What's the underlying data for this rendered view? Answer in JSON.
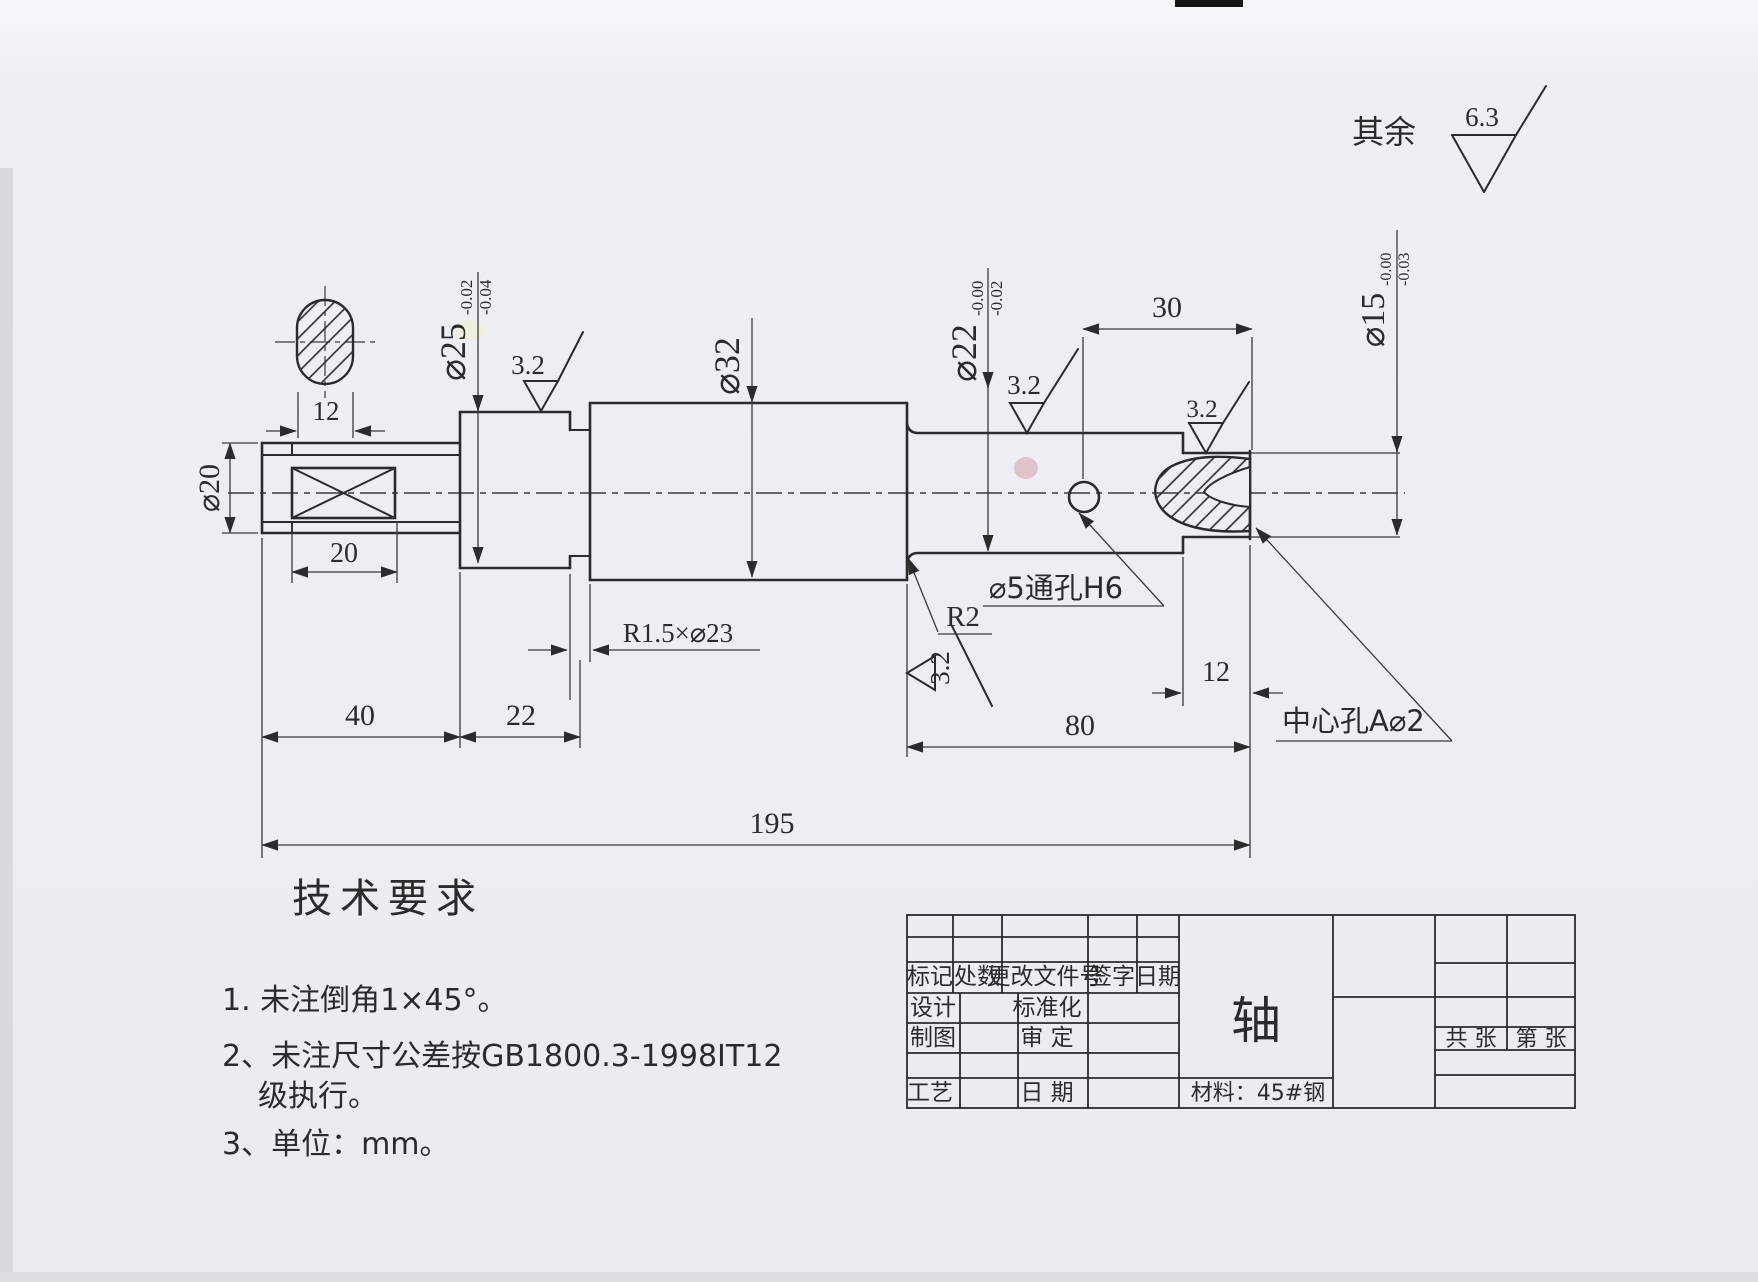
{
  "general": {
    "rest_label": "其余",
    "rest_roughness": "6.3"
  },
  "dims": {
    "key_width": "12",
    "d20": "⌀20",
    "len20": "20",
    "len40": "40",
    "len22": "22",
    "d25": "⌀25",
    "d25_up": "-0.02",
    "d25_lo": "-0.04",
    "ra1": "3.2",
    "ra2": "3.2",
    "ra3": "3.2",
    "ra4": "3.2",
    "groove": "R1.5×⌀23",
    "d32": "⌀32",
    "r2": "R2",
    "d22": "⌀22",
    "d22_up": "-0.00",
    "d22_lo": "-0.02",
    "hole": "⌀5通孔H6",
    "len30": "30",
    "d15": "⌀15",
    "d15_up": "-0.00",
    "d15_lo": "-0.03",
    "len12": "12",
    "len80": "80",
    "len195": "195",
    "center_hole": "中心孔A⌀2"
  },
  "tech": {
    "title": "技术要求",
    "item1": "1. 未注倒角1×45°。",
    "item2": "2、未注尺寸公差按GB1800.3-1998IT12",
    "item2b": "级执行。",
    "item3": "3、单位：mm。"
  },
  "titleblock": {
    "mark": "标记",
    "qty": "处数",
    "doc": "更改文件号",
    "sign": "签字",
    "date": "日期",
    "design": "设计",
    "std": "标准化",
    "draft": "制图",
    "approve": "审  定",
    "craft": "工艺",
    "date2": "日  期",
    "part": "轴",
    "material": "材料：45#钢",
    "sheets_total": "共  张",
    "sheet_no": "第  张"
  }
}
